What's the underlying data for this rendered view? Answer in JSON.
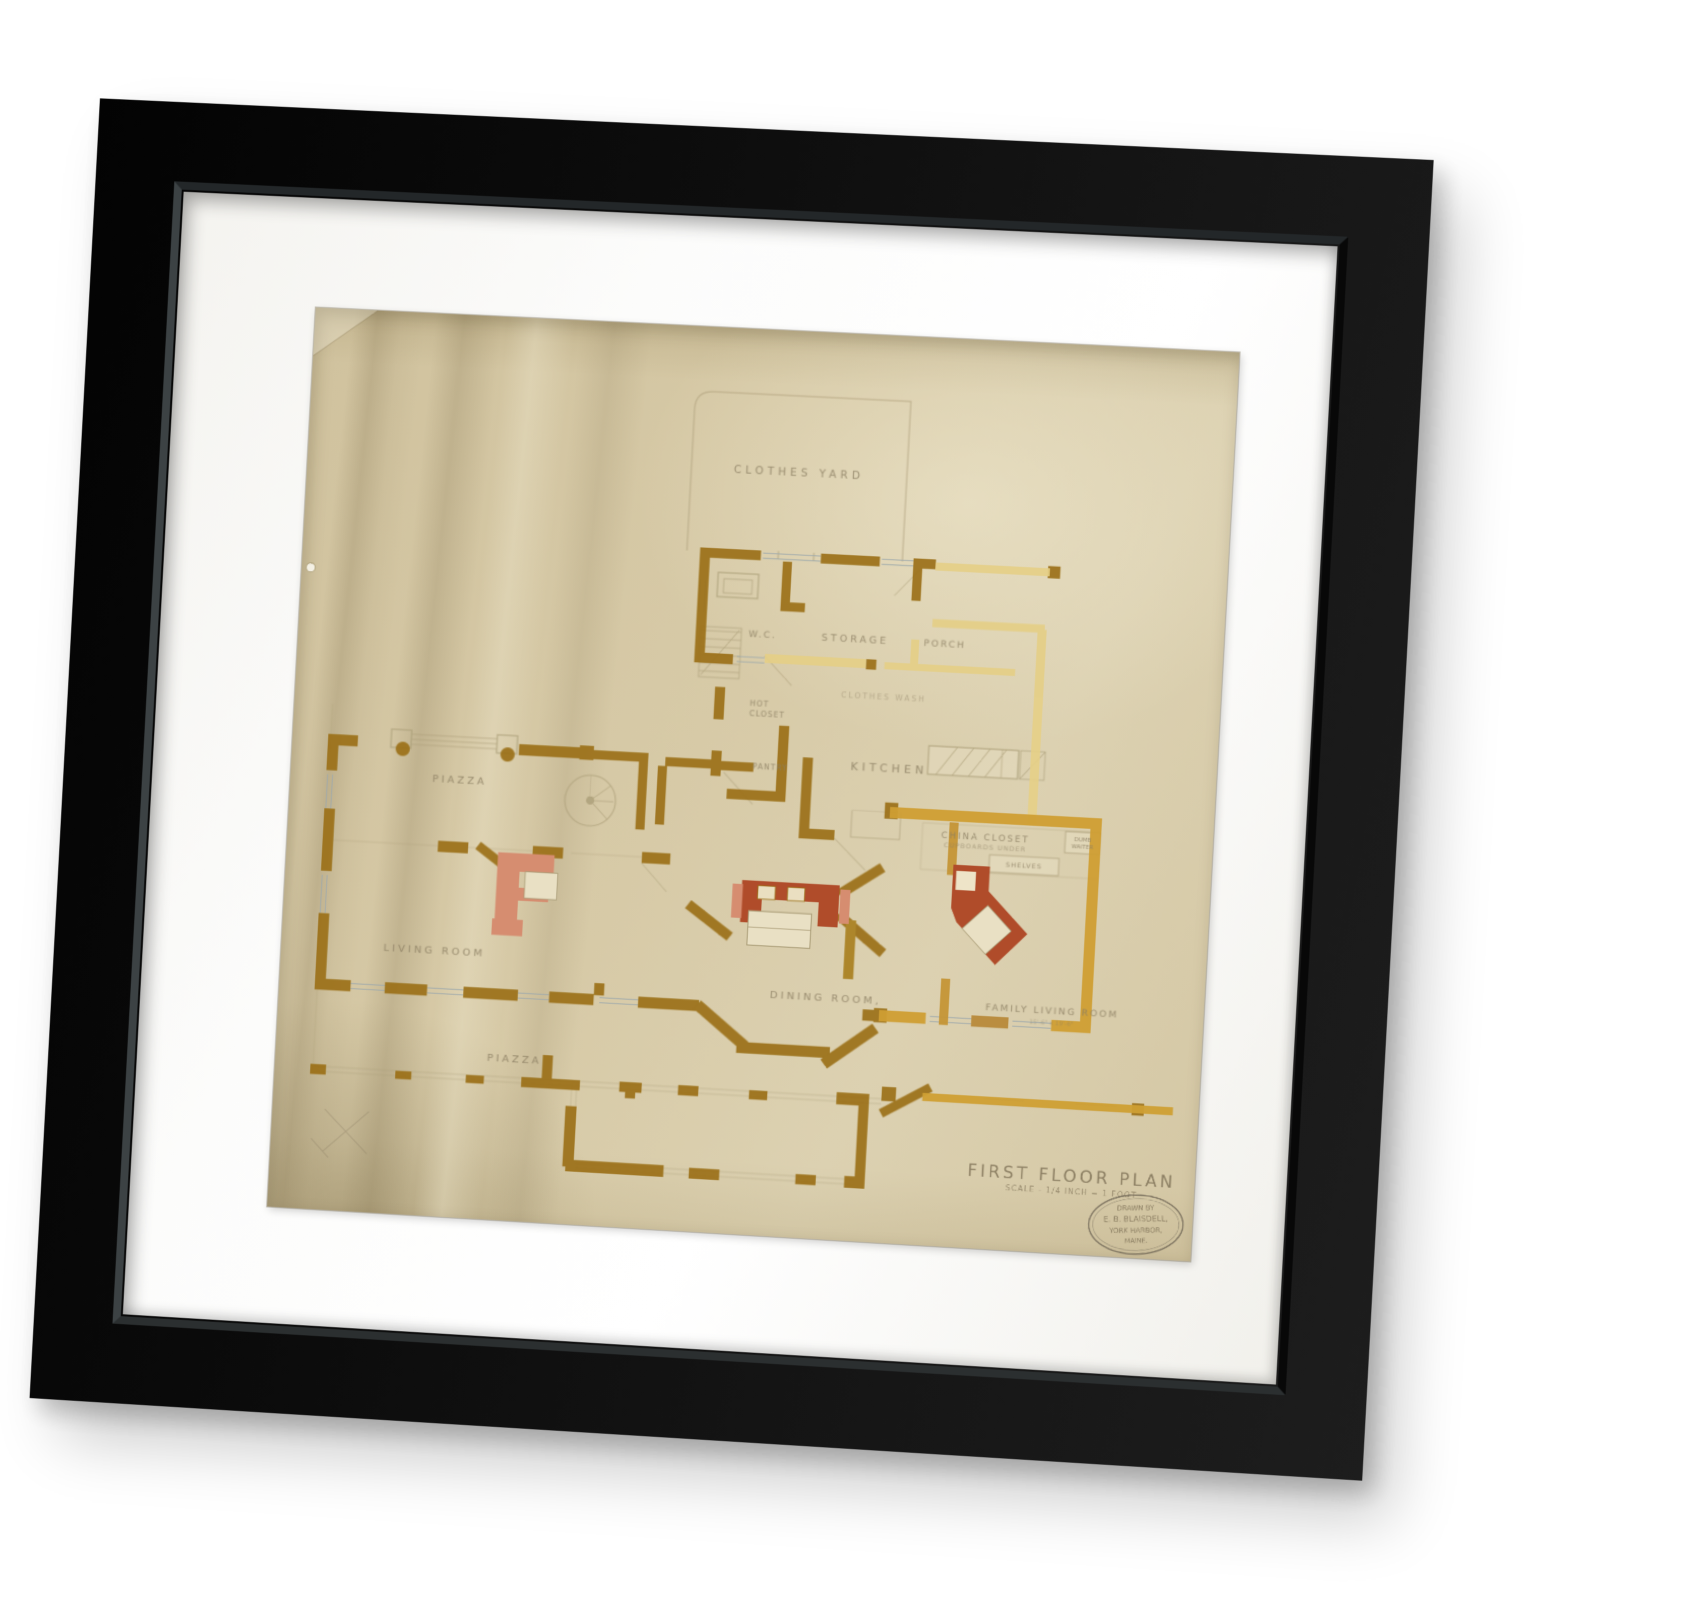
{
  "plan": {
    "rooms": {
      "clothes_yard": "CLOTHES YARD",
      "wc": "W.C.",
      "storage": "STORAGE",
      "porch": "PORCH",
      "clothes_wash": "CLOTHES WASH",
      "hot_closet_line1": "HOT",
      "hot_closet_line2": "CLOSET",
      "pantry": "PANTRY",
      "kitchen": "KITCHEN",
      "china_closet": "CHINA CLOSET",
      "cupboards_under": "CUPBOARDS UNDER",
      "shelves": "SHELVES",
      "dumb_waiter_line1": "DUMB",
      "dumb_waiter_line2": "WAITER",
      "piazza_left": "PIAZZA",
      "living_room": "LIVING ROOM",
      "dining_room": "DINING ROOM,",
      "family_living_room": "FAMILY LIVING ROOM",
      "family_living_room_dim": "15'-6\" x 19'-6\"",
      "piazza_bottom": "PIAZZA"
    },
    "title_block": {
      "title": "FIRST FLOOR PLAN",
      "scale": "SCALE - 1/4 INCH = 1 FOOT"
    },
    "stamp": {
      "line1": "DRAWN BY",
      "line2": "E. B. BLAISDELL,",
      "line3": "YORK HARBOR,",
      "line4": "MAINE."
    },
    "colors": {
      "paper": "#d6c9a6",
      "wall_dark_ochre": "#9b7017",
      "wall_gold": "#cf9f33",
      "wall_pale": "#e5cf86",
      "chimney_red": "#b04c2a",
      "chimney_pink": "#d68d70",
      "pencil": "#8c7f63",
      "window_line": "#9fa9ab",
      "frame": "#0d0d0d",
      "mat": "#fbfbf9"
    }
  }
}
